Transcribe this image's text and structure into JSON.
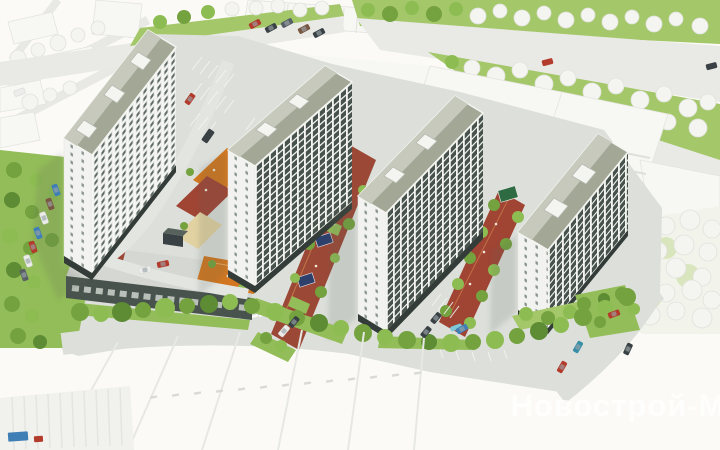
{
  "watermark": {
    "text": "Новострой-М"
  },
  "scene": {
    "description": "aerial 3d render of residential complex",
    "buildings": 4,
    "playground_colors": [
      "orange",
      "maroon",
      "sand"
    ]
  },
  "palette": {
    "bg": "#fbfaf6",
    "siteBase": "#dcdfda",
    "roadLight": "#e3e5e1",
    "roadPale": "#e9eae5",
    "roof": "#a2a796",
    "roofLight": "#c6c9bc",
    "parapet": "#f4f5f1",
    "facDark": "#47524c",
    "facLight": "#e9ebe7",
    "winDark": "#5f6a64",
    "gableWall": "#f2f3f0",
    "gableWin": "#8a948e",
    "groundFloor": "#333c38",
    "whiteBldg": "#f7f7f4",
    "whiteEdge": "#e3e4df",
    "podium": "#49534d",
    "podiumDeck": "#d4d7d2",
    "shopGlass": "#cdd3cd",
    "orange": "#d2771f",
    "orangeLine": "#e8a559",
    "maroon": "#a04434",
    "maroon2": "#9c4836",
    "sand": "#e2d2a2",
    "lawn": "#93bd58",
    "lawn2": "#a3c769",
    "lawnPale": "#d9e6bd",
    "tree1": "#74a23f",
    "tree2": "#8dbd52",
    "tree3": "#5d8c34",
    "treeWhite": "#f4f4f0",
    "treeWhiteEdge": "#e1e2dc",
    "canopy": "#2d3f6b",
    "gazebo": "#2e6b43",
    "pool": "#7ec8d8",
    "carRed": "#b23b2c",
    "carBlue": "#3f7fb6",
    "carTeal": "#3a8fa8",
    "carDark": "#3a4145",
    "carGray": "#596065",
    "carBrown": "#7a5743",
    "carWhite": "#ececea",
    "glass": "#9aa4a8",
    "shadow": "rgba(90,96,90,0.16)",
    "watermark": "rgba(255,255,255,0.78)"
  }
}
